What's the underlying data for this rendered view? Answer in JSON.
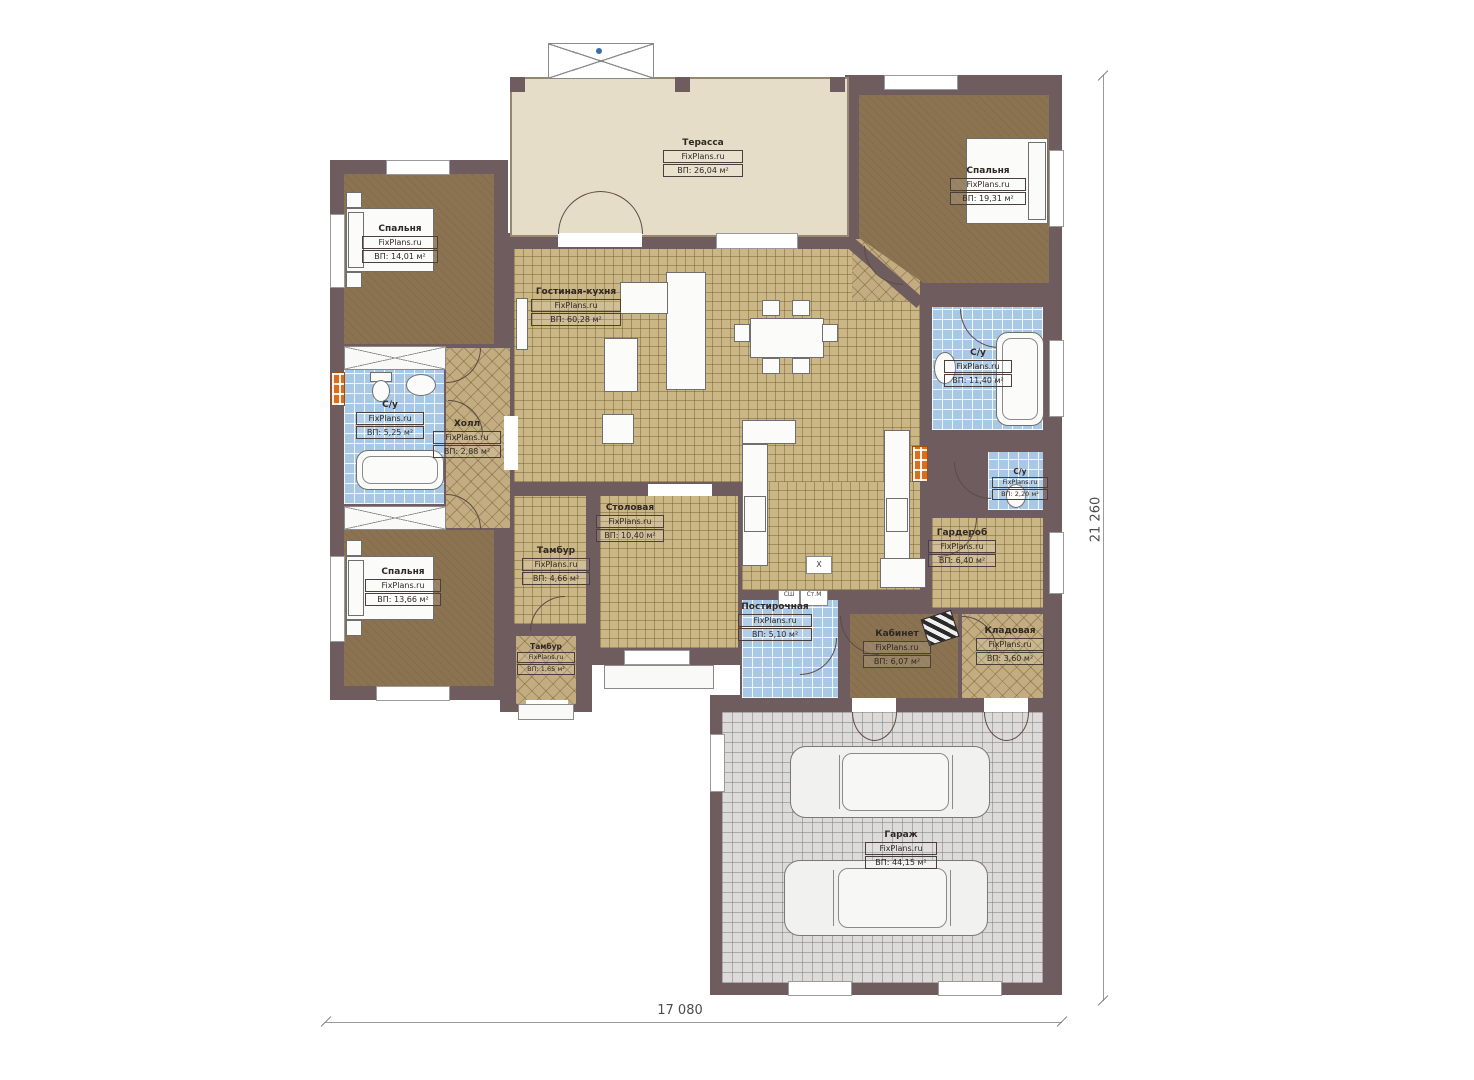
{
  "plan": {
    "watermark": "FixPlans.ru",
    "dimensions": {
      "width": "17 080",
      "height": "21 260"
    },
    "labels": {
      "boiler": "X",
      "dryer": "СШ",
      "washer": "Ст.М"
    },
    "colors": {
      "wall": "#6f5c5e",
      "floor_tan": "#cbb686",
      "floor_brown": "#8b7351",
      "floor_blue": "#a9c8e6",
      "floor_gray": "#dcdbd9",
      "terrace": "#e6ddc8",
      "radiator": "#d96f1e",
      "furniture": "#fbfbf9"
    },
    "rooms": [
      {
        "id": "terrace",
        "name": "Терасса",
        "area": "ВП: 26,04 м²"
      },
      {
        "id": "bedroom_tr",
        "name": "Спальня",
        "area": "ВП: 19,31 м²"
      },
      {
        "id": "bedroom_tl",
        "name": "Спальня",
        "area": "ВП: 14,01 м²"
      },
      {
        "id": "living",
        "name": "Гостиная-кухня",
        "area": "ВП: 60,28 м²"
      },
      {
        "id": "bath_right",
        "name": "С/у",
        "area": "ВП: 11,40 м²"
      },
      {
        "id": "bath_left",
        "name": "С/у",
        "area": "ВП: 5,25 м²"
      },
      {
        "id": "hall",
        "name": "Холл",
        "area": "ВП: 2,88 м²"
      },
      {
        "id": "su_small",
        "name": "С/у",
        "area": "ВП: 2,20 м²"
      },
      {
        "id": "wardrobe",
        "name": "Гардероб",
        "area": "ВП: 6,40 м²"
      },
      {
        "id": "dining",
        "name": "Столовая",
        "area": "ВП: 10,40 м²"
      },
      {
        "id": "tambur",
        "name": "Тамбур",
        "area": "ВП: 4,66 м²"
      },
      {
        "id": "bedroom_bl",
        "name": "Спальня",
        "area": "ВП: 13,66 м²"
      },
      {
        "id": "tambur_small",
        "name": "Тамбур",
        "area": "ВП: 1,65 м²"
      },
      {
        "id": "laundry",
        "name": "Постирочная",
        "area": "ВП: 5,10 м²"
      },
      {
        "id": "office",
        "name": "Кабинет",
        "area": "ВП: 6,07 м²"
      },
      {
        "id": "storage",
        "name": "Кладовая",
        "area": "ВП: 3,60 м²"
      },
      {
        "id": "garage",
        "name": "Гараж",
        "area": "ВП: 44,15 м²"
      }
    ]
  }
}
